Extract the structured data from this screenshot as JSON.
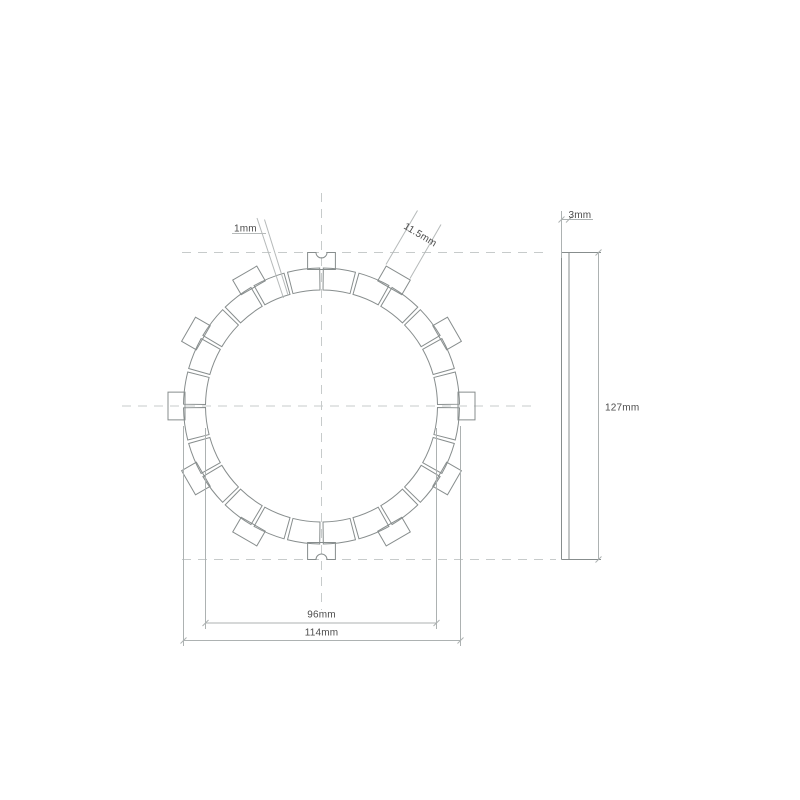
{
  "page": {
    "width": 800,
    "height": 800,
    "background": "#ffffff"
  },
  "palette": {
    "outline": "#878d8d",
    "dimension": "#adb2b2",
    "centerline": "#c7cbcb",
    "leader": "#b6baba",
    "text": "#4c4c4c"
  },
  "labels": {
    "groove_width": "1mm",
    "tab_width": "11.5mm",
    "plate_thickness": "3mm",
    "overall_diameter": "127mm",
    "friction_ring_outer_diameter": "114mm",
    "friction_ring_inner_diameter": "96mm"
  },
  "drawing": {
    "type": "technical-drawing",
    "subject": "clutch friction plate, front view and side view",
    "front_view": {
      "cx": 321.5,
      "cy": 406,
      "ring_inner_radius": 116,
      "ring_outer_radius": 138,
      "tab_inner_radius": 136.5,
      "tab_outer_radius": 153.5,
      "tab_half_width": 13.9,
      "tab_count": 12,
      "tab_angle_step": 30,
      "notched_tab_angles": [
        90,
        270
      ],
      "notch_radius": 5.5,
      "pad_count": 24,
      "pad_angle_step": 15,
      "pad_edge_inset_deg": 0.75
    },
    "centerlines": [
      {
        "name": "horizontal-centerline",
        "x1": 122,
        "y1": 406,
        "x2": 533,
        "y2": 406
      },
      {
        "name": "top-tangent-centerline",
        "x1": 182,
        "y1": 252.5,
        "x2": 550,
        "y2": 252.5
      },
      {
        "name": "bottom-tangent-centerline",
        "x1": 182,
        "y1": 559.5,
        "x2": 556,
        "y2": 559.5
      },
      {
        "name": "vertical-centerline",
        "x1": 321.5,
        "y1": 193,
        "x2": 321.5,
        "y2": 610
      }
    ],
    "side_view": {
      "left": 561.5,
      "right": 569,
      "top": 252.5,
      "bottom": 559.5,
      "cap_right": 601
    },
    "dimensions": {
      "d96": {
        "ext_x1": 205.5,
        "ext_x2": 436.5,
        "ext_top": 428,
        "ext_bottom": 629,
        "line_y": 623
      },
      "d114": {
        "ext_x1": 183.5,
        "ext_x2": 460.5,
        "ext_top": 426,
        "ext_bottom": 646,
        "line_y": 640.5
      },
      "d127": {
        "line_x": 598.5,
        "y1": 252.5,
        "y2": 559.5
      },
      "d3": {
        "ext_x": 561.5,
        "ext_y1": 211,
        "ext_y2": 258,
        "line_y": 219.5,
        "line_x1": 561.5,
        "line_x2": 593,
        "tick_xs": [
          561.5,
          569
        ]
      },
      "leader_1mm": {
        "underline": {
          "x1": 232,
          "y": 233.5,
          "x2": 266
        },
        "lines": [
          [
            257,
            218,
            283.5,
            298
          ],
          [
            264.5,
            219.5,
            288,
            295
          ]
        ]
      },
      "leader_11_5mm": {
        "lines": [
          [
            386,
            264.5,
            417.5,
            210.5
          ],
          [
            410,
            278.5,
            441,
            224.5
          ]
        ]
      }
    }
  }
}
